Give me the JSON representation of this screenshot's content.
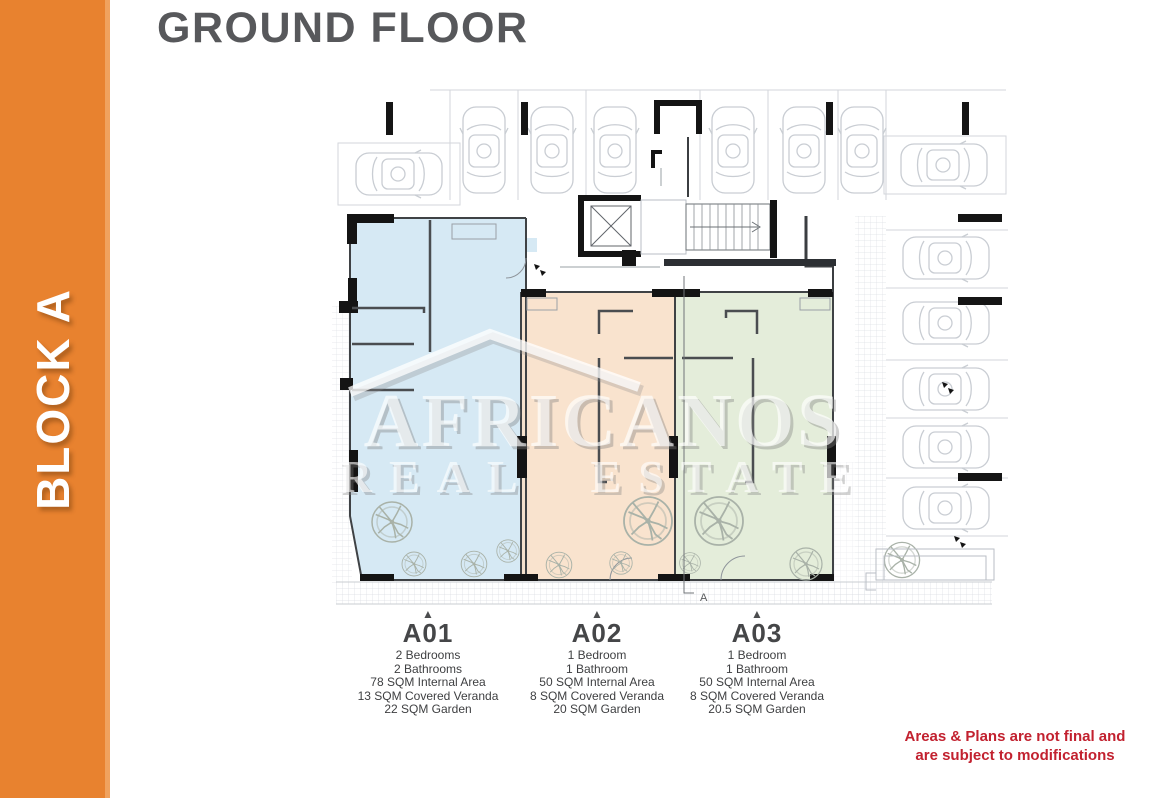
{
  "sidebar": {
    "label": "BLOCK A",
    "color": "#e8822f",
    "edge_color": "#f0a25e",
    "text_color": "#ffffff"
  },
  "header": {
    "title": "GROUND FLOOR",
    "color": "#57585b"
  },
  "watermark": {
    "line1": "AFRICANOS",
    "line2": "REAL ESTATE"
  },
  "plan": {
    "section_label": "A"
  },
  "units": [
    {
      "code": "A01",
      "marker": "▲",
      "color": "#d2e7f3",
      "details": [
        "2 Bedrooms",
        "2 Bathrooms",
        "78 SQM Internal Area",
        "13 SQM Covered Veranda",
        "22 SQM Garden"
      ]
    },
    {
      "code": "A02",
      "marker": "▲",
      "color": "#f8e0c9",
      "details": [
        "1 Bedroom",
        "1 Bathroom",
        "50 SQM Internal Area",
        "8 SQM Covered Veranda",
        "20 SQM Garden"
      ]
    },
    {
      "code": "A03",
      "marker": "▲",
      "color": "#e1ebd6",
      "details": [
        "1 Bedroom",
        "1 Bathroom",
        "50 SQM Internal Area",
        "8 SQM Covered Veranda",
        "20.5 SQM Garden"
      ]
    }
  ],
  "disclaimer": {
    "line1": "Areas & Plans are not final and",
    "line2": "are subject to modifications",
    "color": "#c2212f"
  }
}
